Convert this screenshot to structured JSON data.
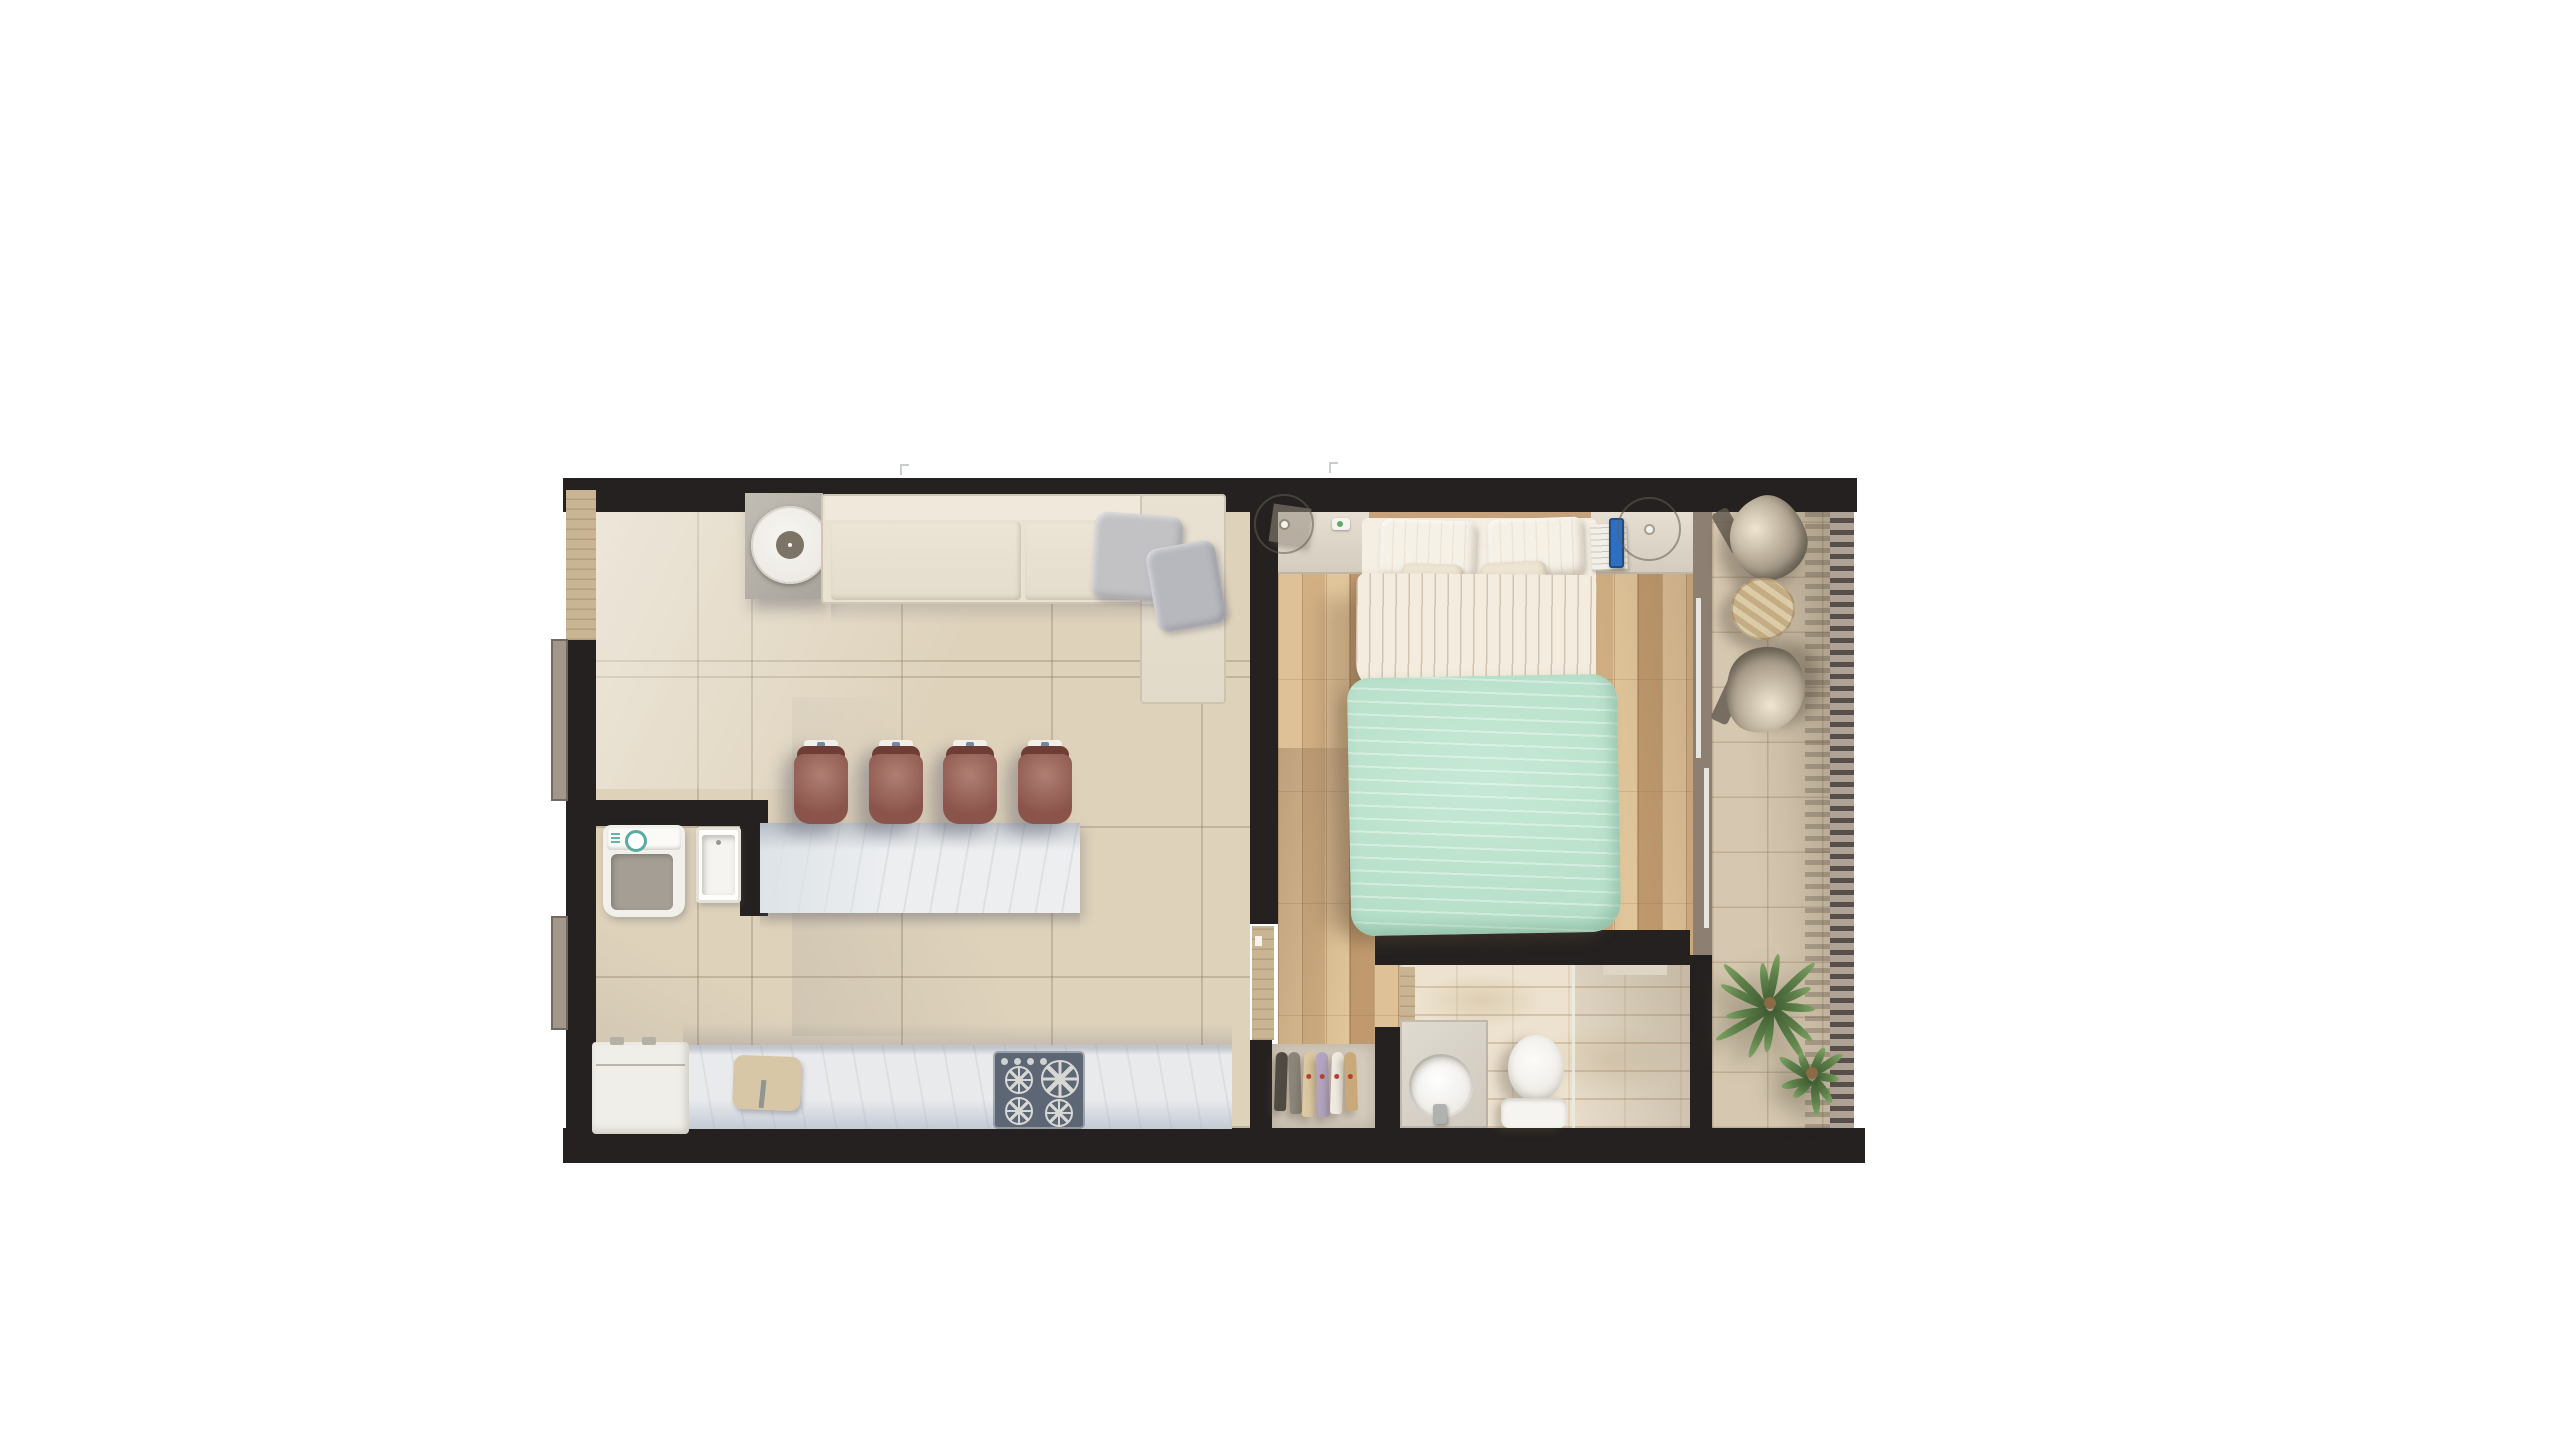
{
  "scene": {
    "type": "apartment-floor-plan-top-view",
    "rooms": [
      "living-kitchen",
      "laundry-nook",
      "bedroom",
      "bathroom",
      "closet",
      "hall",
      "balcony"
    ]
  },
  "kitchen": {
    "bar_stools": 4,
    "stove_burners": 4
  },
  "closet": {
    "clothes_colors": [
      "#4f4a42",
      "#8b857a",
      "#dcc9a2",
      "#b3a5c1",
      "#efebe0",
      "#c9a87a"
    ]
  },
  "balcony": {
    "lounge_chairs": 2,
    "plants": [
      {
        "leaves": 13
      },
      {
        "leaves": 9
      }
    ]
  },
  "palette": {
    "wall": "#242120",
    "entry_door": "#c9b594",
    "window_frame": "#a3968a",
    "living_floor": "#ded2bb",
    "living_grout": "rgba(130,112,85,0.30)",
    "island_marble": "#eceef0",
    "counter_marble": "#e8eaec",
    "stool": "#8a544b",
    "stool_light": "#b07f72",
    "sofa": "#e9e1d1",
    "pillow_gray": "#c2c2c4",
    "tray_center": "#7d7468",
    "stove": "#5d6674",
    "fridge": "#f0eee8",
    "washer": "#f2f0ea",
    "washer_drum": "#a49e95",
    "board": "#d8c7a6",
    "wood_light": "#dfc197",
    "wood_mid": "#d2b084",
    "wood_dark": "#c09a6e",
    "headboard": "#c6a37c",
    "bed_sheet": "#f4eee3",
    "pillow_white": "#f6f1e7",
    "pillow_cream": "#eee4d2",
    "duvet": "#b9e4cd",
    "phone": "#2f6fc1",
    "bath_floor": "#ece2cf",
    "bath_line": "rgba(170,140,100,0.35)",
    "porcelain": "#f6f4f0",
    "closet_floor": "#d8cec0",
    "balcony_floor": "#d6c8b0",
    "balcony_line": "rgba(130,105,75,0.28)",
    "railing": "#b0a294",
    "railing_dash": "#57504a",
    "frame_taupe": "#8d8073",
    "chair_metal_hi": "#efe6d2",
    "chair_metal_lo": "#7e7466",
    "table_stripe_a": "#dbcba7",
    "table_stripe_b": "#c4ad85",
    "plant": "#5d8049",
    "plant_dark": "#3f5c33"
  }
}
